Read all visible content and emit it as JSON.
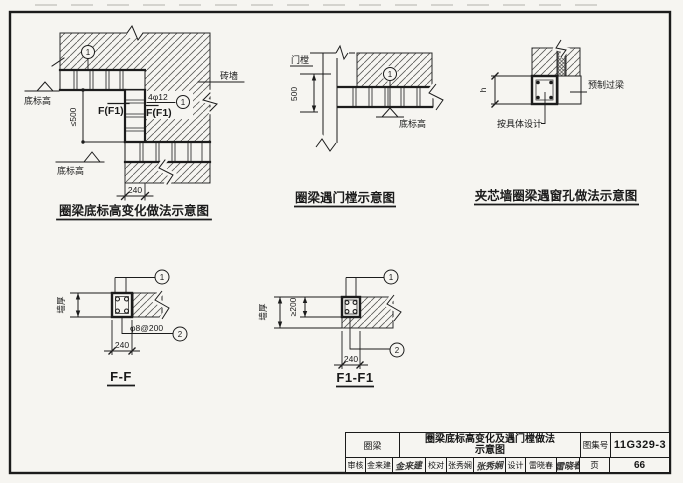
{
  "diagram1": {
    "title": "圈梁底标高变化做法示意图",
    "brick_wall": "砖墙",
    "bottom_elev_upper": "底标高",
    "bottom_elev_lower": "底标高",
    "dim_step": "≤500",
    "dim_width": "240",
    "rebar": "4φ12",
    "section_mark_left": "F(F1)",
    "section_mark_right": "F(F1)",
    "callout_top": "1",
    "callout_mid": "1"
  },
  "diagram2": {
    "title": "圈梁遇门樘示意图",
    "door_frame": "门樘",
    "dim_height": "500",
    "bottom_elev": "底标高",
    "callout": "1"
  },
  "diagram3": {
    "title": "夹芯墙圈梁遇窗孔做法示意图",
    "dim_h": "h",
    "precast_lintel": "预制过梁",
    "per_design": "按具体设计"
  },
  "section_ff": {
    "title": "F-F",
    "wall_thickness": "墙厚",
    "dim_width": "240",
    "stirrup": "φ8@200",
    "callout_top": "1",
    "callout_bottom": "2"
  },
  "section_f1f1": {
    "title": "F1-F1",
    "wall_thickness": "墙厚",
    "dim_beam": "≥200",
    "dim_width": "240",
    "callout_top": "1",
    "callout_bottom": "2"
  },
  "title_block": {
    "category": "圈梁",
    "sheet_title_line1": "圈梁底标高变化及遇门樘做法",
    "sheet_title_line2": "示意图",
    "atlas_label": "图集号",
    "atlas_no": "11G329-3",
    "review_label": "审核",
    "reviewer": "金来建",
    "reviewer_sig": "金来建",
    "check_label": "校对",
    "checker": "张秀娴",
    "checker_sig": "张秀娴",
    "design_label": "设计",
    "designer": "雷晓春",
    "designer_sig": "雷晓春",
    "page_label": "页",
    "page_no": "66"
  }
}
